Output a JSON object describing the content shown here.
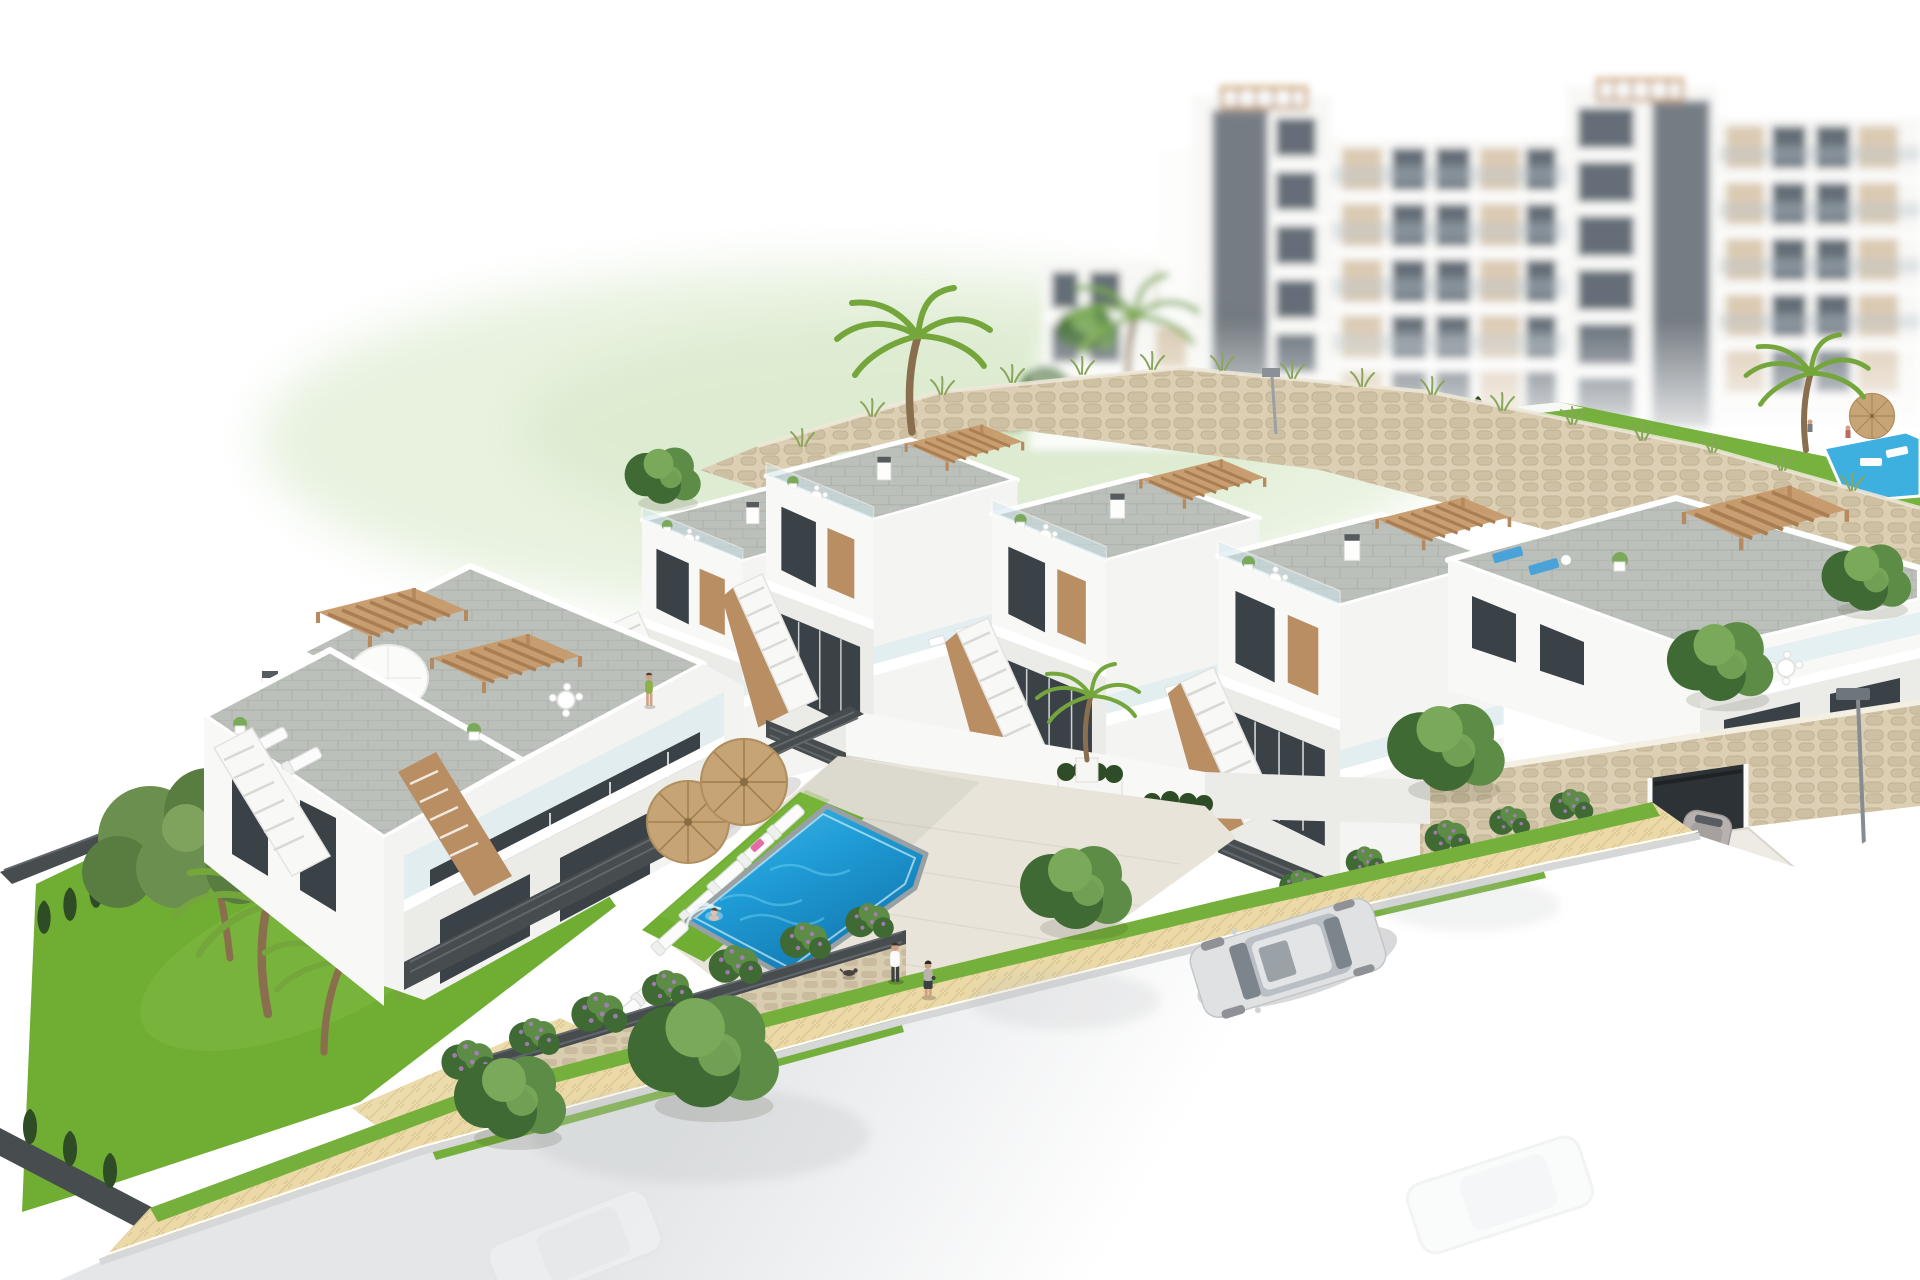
{
  "meta": {
    "title": "Aerial 3D architectural rendering of a modern white hillside residential development with stepped townhouses, communal swimming pool, stone retaining walls and blurred apartment blocks behind; street in the foreground fades to white",
    "view": "aerial three-quarter",
    "lighting": "bright daylight"
  },
  "colors": {
    "white": "#ffffff",
    "white_wall": "#f8f8f6",
    "wall_shade": "#ebebe8",
    "wall_dark": "#dddddb",
    "tile": "#bcc0ba",
    "tile_line": "#acb0aa",
    "deck": "#e8e4da",
    "deck_line": "#d8d3c7",
    "pergola": "#c79a6b",
    "pergola_dark": "#a87e52",
    "door_tan": "#b98e63",
    "window_dark": "#3a4147",
    "glass_blue": "#cfe7ee",
    "fence_dark": "#474c4f",
    "fence_slat": "#61676b",
    "stone_bg": "#dccfb4",
    "stone_block": "#cec0a2",
    "stone_line": "#c1b294",
    "stone2_bg": "#d8ccb1",
    "stone2_block": "#cabb9e",
    "lawn": "#6fae33",
    "lawn_light": "#82bc44",
    "verge": "#76b03c",
    "hedge": "#2e4c25",
    "tree_dark": "#3f6a33",
    "tree_mid": "#5c8c45",
    "tree_light": "#7aa95a",
    "palm": "#74a63c",
    "trunk": "#8a6f4e",
    "pool_light": "#49bdea",
    "pool_water": "#1f9cd6",
    "pool_deep": "#1173ab",
    "pool_rim": "#98a0a3",
    "umbrella": "#c7a476",
    "umbrella_rib": "#a3814f",
    "sand": "#ebdaa7",
    "sand_line": "#dcc794",
    "road_gray": "#e4e6e8",
    "curb": "#d6d7d8",
    "car_silver": "#dfe1e3",
    "car_glass": "#7c858c",
    "coupe_gray": "#b7b2b0",
    "skin": "#cfa183",
    "pants_dark": "#3c4043",
    "pink": "#e45b9a",
    "hill": "#e4f0da",
    "hill2": "#d9e9cc",
    "grass_tuft": "#8aa65e",
    "shaft": "#79818a",
    "panel_beige": "#d9c7ae",
    "bg_glass": "#5b6670",
    "flower_purple": "#b07cc6"
  },
  "scene": {
    "background_apartments": {
      "label": "blurred white apartment blocks with beige facade panels, glass balconies, dark lift shafts and rooftop pergola frames",
      "blocks": 5
    },
    "upper_garden": {
      "label": "upper terrace garden behind the big retaining wall",
      "small_pool": true,
      "umbrellas": 1,
      "cypress_row": true
    },
    "retaining_wall": {
      "label": "rustic beige stone retaining wall topped with wild grasses"
    },
    "townhouse_row": {
      "label": "stepped row of two-storey white townhouses with grey tiled roof terraces",
      "units": 5,
      "features": [
        "tan timber pergolas",
        "external staircases",
        "glass balustrades",
        "dark slatted fences",
        "roof dining sets",
        "blue roof loungers on end unit"
      ]
    },
    "left_block": {
      "label": "two-unit white townhouse block",
      "features": [
        "roof terraces",
        "two tan pergolas",
        "white parasol",
        "outdoor dining table",
        "sun loungers",
        "tan accent stair walls"
      ]
    },
    "pool_area": {
      "label": "communal swimming pool with lawn sun deck",
      "umbrellas": 2,
      "sun_loungers": 7,
      "planters": 3,
      "steps_in_pool": true
    },
    "garage": {
      "label": "basement garage opening in stone plinth with concrete driveway"
    },
    "street": {
      "label": "curved street fading to white at the lower edge",
      "street_lamps": 2,
      "sandy_sidewalk": true,
      "grass_verges": true
    },
    "vegetation": {
      "palms": 4,
      "pine_trees": 1,
      "leafy_trees": 8,
      "cypress_hedges": true,
      "flowering_shrubs": "green with purple blossom"
    },
    "people": [
      {
        "label": "man in white shirt walking on sidewalk"
      },
      {
        "label": "woman walking beside him"
      },
      {
        "label": "small dog on sidewalk"
      },
      {
        "label": "woman sunbathing on lounger by pool"
      },
      {
        "label": "woman on steps in the pool"
      },
      {
        "label": "person walking on townhouse terrace"
      },
      {
        "label": "two tiny figures at the upper garden pool"
      }
    ],
    "vehicles": [
      {
        "label": "silver sedan parked at the curb"
      },
      {
        "label": "grey sports coupe on the garage driveway"
      },
      {
        "label": "two faded white cars at the bottom edge"
      }
    ]
  }
}
